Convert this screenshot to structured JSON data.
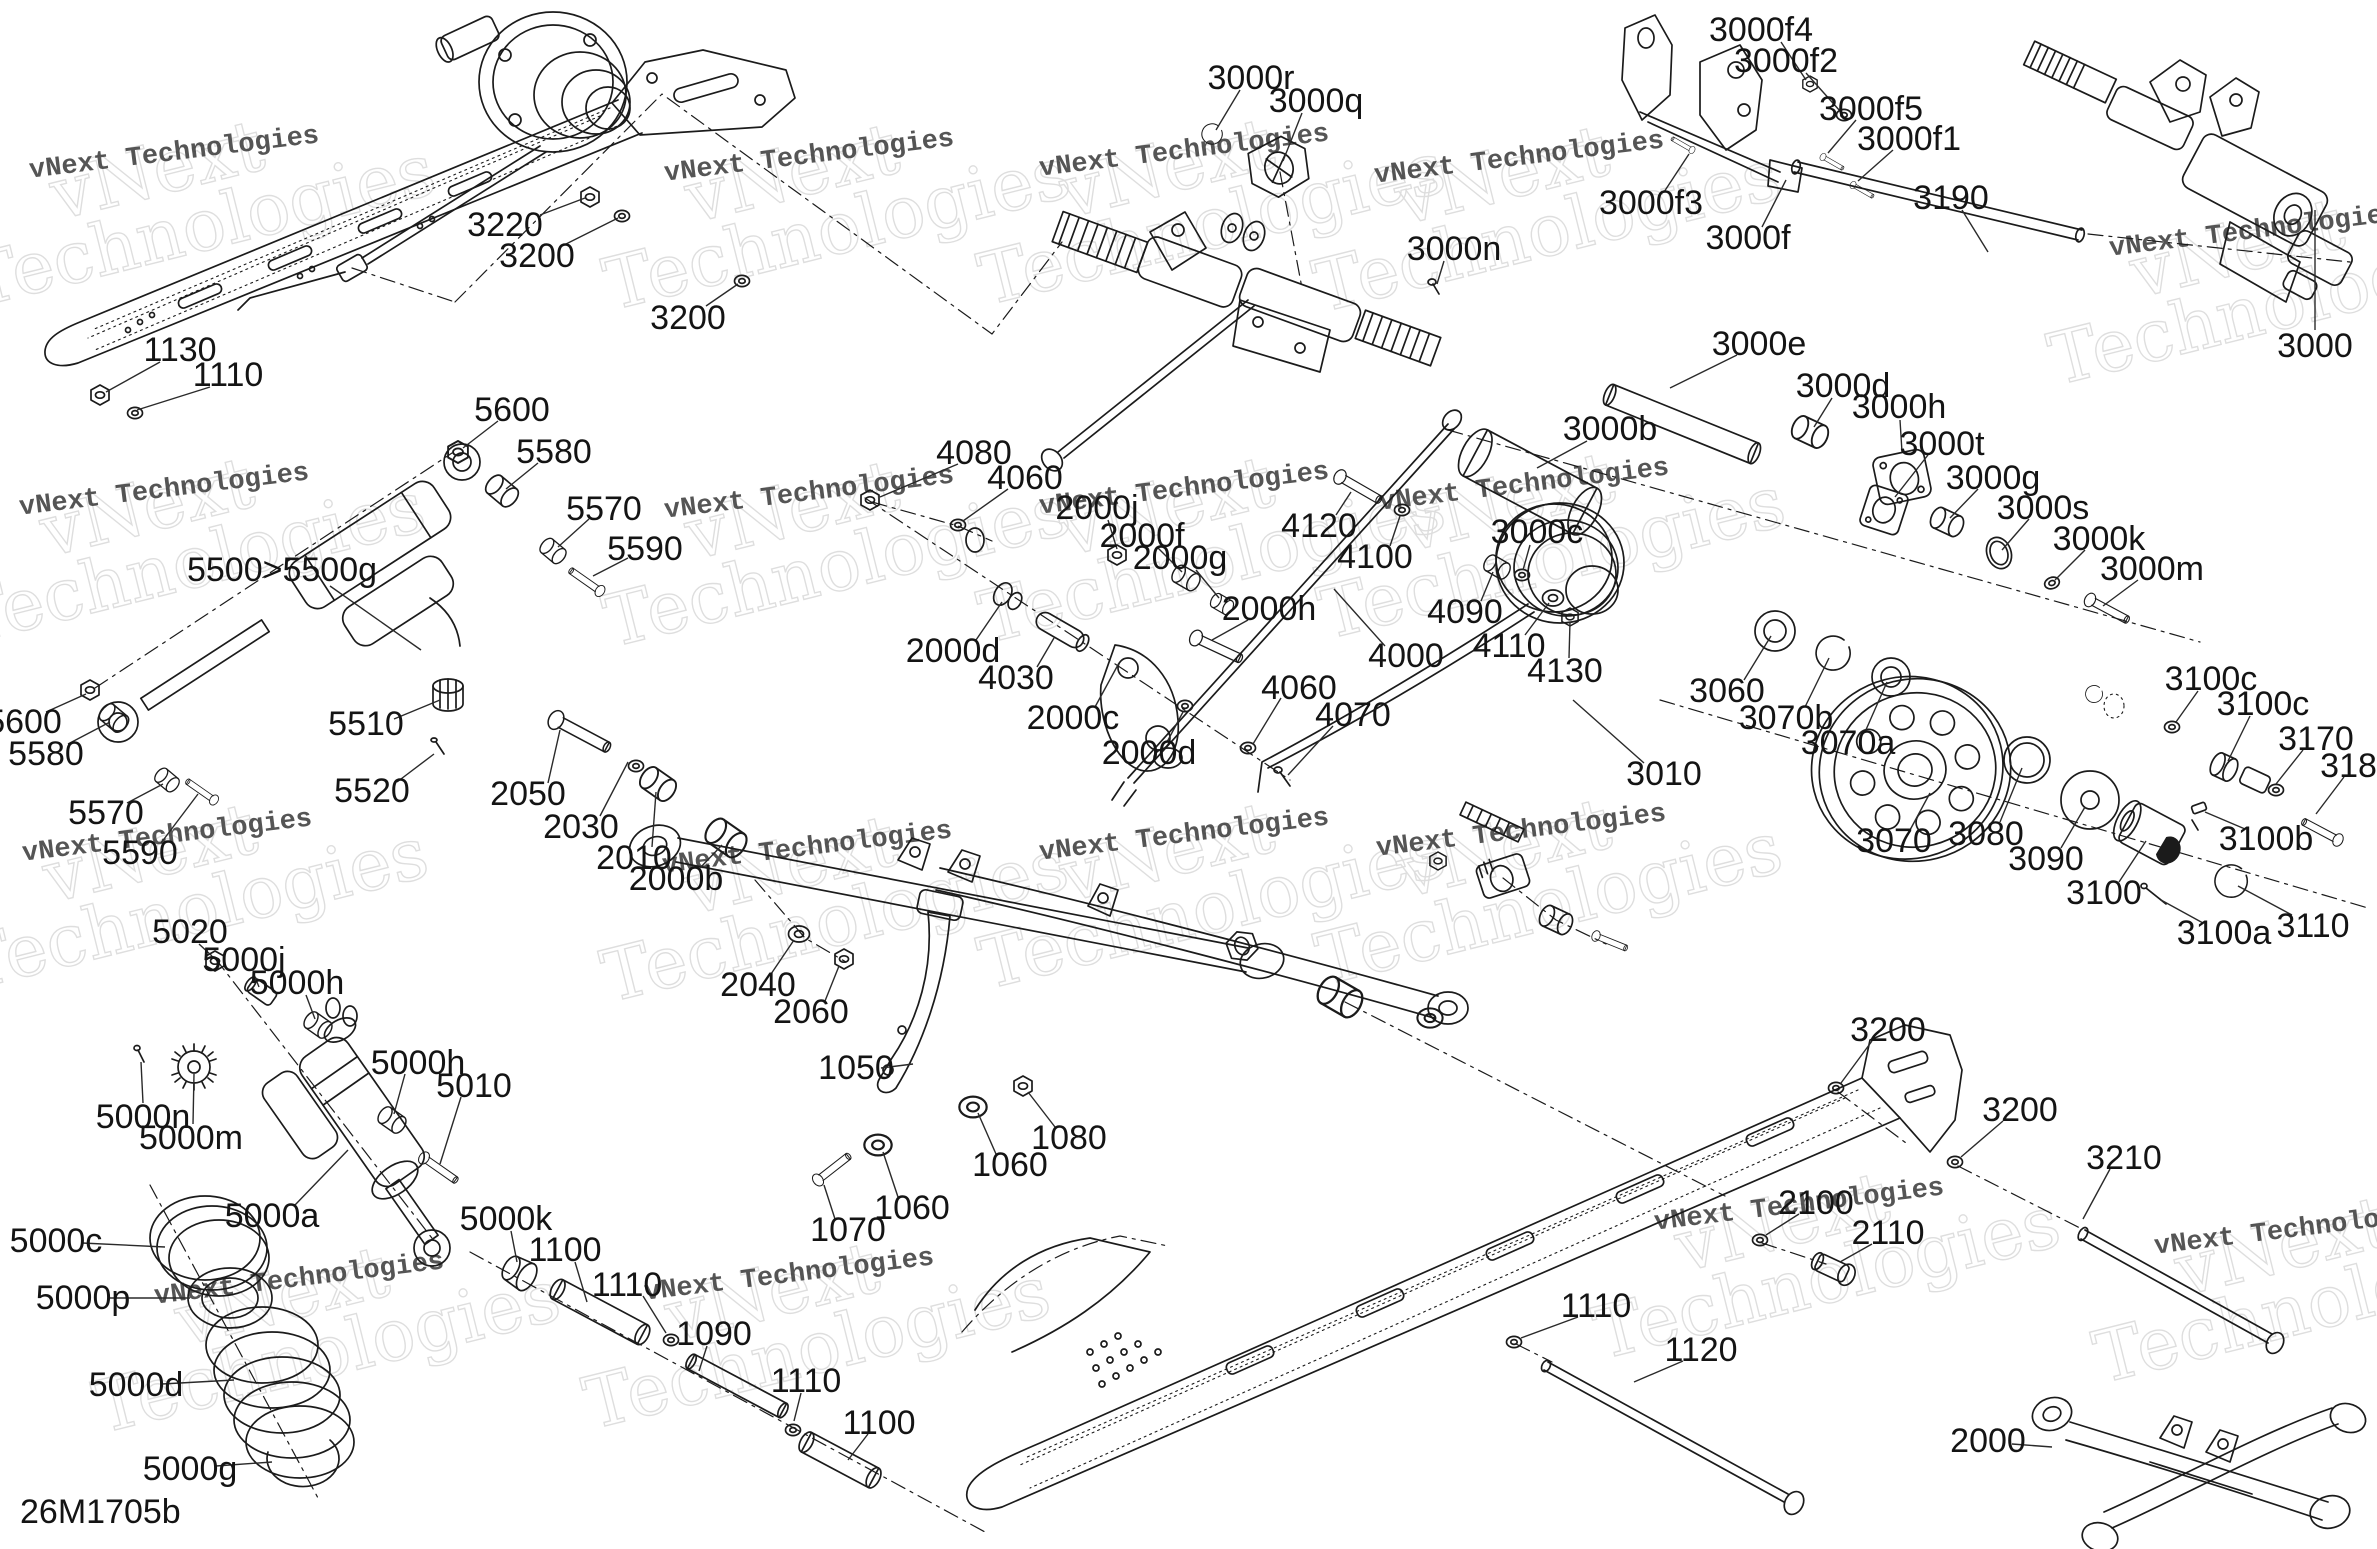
{
  "diagram": {
    "code": "26M1705b",
    "colors": {
      "line": "#1b1b1b",
      "label": "#141414",
      "watermark_small": "#3e3e3e",
      "watermark_big_outline": "#dddddd",
      "background": "#ffffff"
    },
    "watermark": {
      "small": "vNext Technologies",
      "big_line1": "vNext",
      "big_line2": "Technologies"
    },
    "watermarks": [
      {
        "x": 175,
        "y": 160
      },
      {
        "x": 810,
        "y": 163
      },
      {
        "x": 1185,
        "y": 158
      },
      {
        "x": 1520,
        "y": 165
      },
      {
        "x": 2255,
        "y": 238
      },
      {
        "x": 165,
        "y": 497
      },
      {
        "x": 810,
        "y": 500
      },
      {
        "x": 1185,
        "y": 496
      },
      {
        "x": 1525,
        "y": 492
      },
      {
        "x": 168,
        "y": 843
      },
      {
        "x": 808,
        "y": 855
      },
      {
        "x": 1185,
        "y": 842
      },
      {
        "x": 1522,
        "y": 838
      },
      {
        "x": 300,
        "y": 1286
      },
      {
        "x": 790,
        "y": 1282
      },
      {
        "x": 1800,
        "y": 1212
      },
      {
        "x": 2300,
        "y": 1236
      }
    ],
    "labels": [
      {
        "t": "3220",
        "x": 505,
        "y": 225,
        "l": [
          540,
          215,
          585,
          198
        ]
      },
      {
        "t": "3200",
        "x": 537,
        "y": 256,
        "l": [
          562,
          246,
          618,
          218
        ]
      },
      {
        "t": "3200",
        "x": 688,
        "y": 318,
        "l": [
          706,
          306,
          738,
          284
        ]
      },
      {
        "t": "1130",
        "x": 180,
        "y": 350,
        "l": [
          160,
          362,
          106,
          392
        ]
      },
      {
        "t": "1110",
        "x": 228,
        "y": 375,
        "l": [
          210,
          387,
          137,
          410
        ]
      },
      {
        "t": "5600",
        "x": 512,
        "y": 410,
        "l": [
          498,
          421,
          463,
          448
        ]
      },
      {
        "t": "5580",
        "x": 554,
        "y": 452,
        "l": [
          538,
          463,
          506,
          489
        ]
      },
      {
        "t": "5570",
        "x": 604,
        "y": 509,
        "l": [
          589,
          519,
          558,
          547
        ]
      },
      {
        "t": "5590",
        "x": 645,
        "y": 549,
        "l": [
          628,
          558,
          593,
          576
        ]
      },
      {
        "t": "5500>5500g",
        "x": 282,
        "y": 570,
        "l": [
          330,
          586,
          421,
          650
        ]
      },
      {
        "t": "5510",
        "x": 366,
        "y": 724,
        "l": [
          394,
          719,
          440,
          700
        ]
      },
      {
        "t": "5520",
        "x": 372,
        "y": 791,
        "l": [
          397,
          782,
          434,
          754
        ]
      },
      {
        "t": "5600",
        "x": 24,
        "y": 722,
        "l": [
          46,
          712,
          86,
          694
        ]
      },
      {
        "t": "5580",
        "x": 46,
        "y": 754,
        "l": [
          68,
          744,
          110,
          722
        ]
      },
      {
        "t": "5570",
        "x": 106,
        "y": 813,
        "l": [
          127,
          803,
          163,
          784
        ]
      },
      {
        "t": "5590",
        "x": 140,
        "y": 853,
        "l": [
          161,
          843,
          198,
          794
        ]
      },
      {
        "t": "2050",
        "x": 528,
        "y": 794,
        "l": [
          548,
          783,
          560,
          730
        ]
      },
      {
        "t": "2030",
        "x": 581,
        "y": 827,
        "l": [
          600,
          816,
          628,
          762
        ]
      },
      {
        "t": "2010",
        "x": 634,
        "y": 858,
        "l": [
          652,
          847,
          656,
          792
        ]
      },
      {
        "t": "2000b",
        "x": 676,
        "y": 879,
        "l": [
          700,
          868,
          722,
          845
        ]
      },
      {
        "t": "4080",
        "x": 974,
        "y": 453,
        "l": [
          958,
          464,
          880,
          497
        ]
      },
      {
        "t": "4060",
        "x": 1025,
        "y": 478,
        "l": [
          1008,
          489,
          963,
          521
        ]
      },
      {
        "t": "2000j",
        "x": 1097,
        "y": 508,
        "l": [
          1108,
          520,
          1117,
          549
        ]
      },
      {
        "t": "2000f",
        "x": 1142,
        "y": 536,
        "l": [
          1158,
          548,
          1182,
          572
        ]
      },
      {
        "t": "2000g",
        "x": 1180,
        "y": 558,
        "l": [
          1196,
          570,
          1219,
          598
        ]
      },
      {
        "t": "2000h",
        "x": 1269,
        "y": 609,
        "l": [
          1248,
          620,
          1212,
          640
        ]
      },
      {
        "t": "2000d",
        "x": 953,
        "y": 651,
        "l": [
          976,
          640,
          1002,
          602
        ]
      },
      {
        "t": "4030",
        "x": 1016,
        "y": 678,
        "l": [
          1037,
          667,
          1054,
          638
        ]
      },
      {
        "t": "2000c",
        "x": 1073,
        "y": 718,
        "l": [
          1095,
          707,
          1119,
          663
        ]
      },
      {
        "t": "2000d",
        "x": 1149,
        "y": 753,
        "l": [
          1167,
          742,
          1183,
          712
        ]
      },
      {
        "t": "4060",
        "x": 1299,
        "y": 688,
        "l": [
          1281,
          698,
          1253,
          744
        ]
      },
      {
        "t": "4070",
        "x": 1353,
        "y": 715,
        "l": [
          1333,
          726,
          1288,
          775
        ]
      },
      {
        "t": "3000r",
        "x": 1251,
        "y": 78,
        "l": [
          1240,
          90,
          1216,
          130
        ]
      },
      {
        "t": "3000q",
        "x": 1316,
        "y": 101,
        "l": [
          1302,
          113,
          1283,
          161
        ]
      },
      {
        "t": "3000n",
        "x": 1454,
        "y": 249,
        "l": [
          1444,
          261,
          1437,
          284
        ]
      },
      {
        "t": "4120",
        "x": 1319,
        "y": 526,
        "l": [
          1336,
          515,
          1351,
          492
        ]
      },
      {
        "t": "4100",
        "x": 1375,
        "y": 557,
        "l": [
          1390,
          546,
          1400,
          516
        ]
      },
      {
        "t": "3000c",
        "x": 1537,
        "y": 532,
        "l": [
          1530,
          545,
          1523,
          570
        ]
      },
      {
        "t": "4090",
        "x": 1465,
        "y": 612,
        "l": [
          1481,
          601,
          1493,
          572
        ]
      },
      {
        "t": "4110",
        "x": 1509,
        "y": 646,
        "l": [
          1525,
          635,
          1549,
          603
        ]
      },
      {
        "t": "4130",
        "x": 1565,
        "y": 671,
        "l": [
          1569,
          658,
          1570,
          622
        ]
      },
      {
        "t": "4000",
        "x": 1406,
        "y": 656,
        "l": [
          1385,
          646,
          1334,
          589
        ]
      },
      {
        "t": "3000b",
        "x": 1610,
        "y": 429,
        "l": [
          1587,
          441,
          1537,
          468
        ]
      },
      {
        "t": "3000e",
        "x": 1759,
        "y": 344,
        "l": [
          1737,
          355,
          1670,
          388
        ]
      },
      {
        "t": "3000d",
        "x": 1843,
        "y": 386,
        "l": [
          1832,
          398,
          1814,
          427
        ]
      },
      {
        "t": "3000h",
        "x": 1899,
        "y": 407,
        "l": [
          1900,
          420,
          1902,
          452
        ]
      },
      {
        "t": "3000t",
        "x": 1942,
        "y": 444,
        "l": [
          1928,
          455,
          1895,
          497
        ]
      },
      {
        "t": "3000g",
        "x": 1993,
        "y": 478,
        "l": [
          1978,
          489,
          1950,
          518
        ]
      },
      {
        "t": "3000s",
        "x": 2043,
        "y": 508,
        "l": [
          2029,
          519,
          2002,
          550
        ]
      },
      {
        "t": "3000k",
        "x": 2099,
        "y": 539,
        "l": [
          2085,
          550,
          2055,
          580
        ]
      },
      {
        "t": "3000m",
        "x": 2152,
        "y": 569,
        "l": [
          2138,
          580,
          2103,
          606
        ]
      },
      {
        "t": "3000",
        "x": 2315,
        "y": 346,
        "l": [
          2315,
          330,
          2315,
          210
        ]
      },
      {
        "t": "3000f4",
        "x": 1761,
        "y": 30,
        "l": [
          1781,
          42,
          1806,
          80
        ]
      },
      {
        "t": "3000f2",
        "x": 1786,
        "y": 61,
        "l": [
          1806,
          73,
          1840,
          111
        ]
      },
      {
        "t": "3000f5",
        "x": 1871,
        "y": 109,
        "l": [
          1856,
          120,
          1828,
          153
        ]
      },
      {
        "t": "3000f1",
        "x": 1909,
        "y": 139,
        "l": [
          1893,
          150,
          1858,
          181
        ]
      },
      {
        "t": "3190",
        "x": 1951,
        "y": 198,
        "l": [
          1962,
          210,
          1988,
          252
        ]
      },
      {
        "t": "3000f3",
        "x": 1651,
        "y": 203,
        "l": [
          1664,
          192,
          1689,
          154
        ]
      },
      {
        "t": "3000f",
        "x": 1748,
        "y": 238,
        "l": [
          1762,
          227,
          1786,
          180
        ]
      },
      {
        "t": "3060",
        "x": 1727,
        "y": 691,
        "l": [
          1744,
          680,
          1771,
          636
        ]
      },
      {
        "t": "3070b",
        "x": 1786,
        "y": 718,
        "l": [
          1805,
          707,
          1829,
          658
        ]
      },
      {
        "t": "3070a",
        "x": 1848,
        "y": 743,
        "l": [
          1865,
          732,
          1887,
          682
        ]
      },
      {
        "t": "3010",
        "x": 1664,
        "y": 774,
        "l": [
          1644,
          763,
          1573,
          700
        ]
      },
      {
        "t": "3070",
        "x": 1894,
        "y": 841,
        "l": [
          1910,
          830,
          1930,
          793
        ]
      },
      {
        "t": "3080",
        "x": 1986,
        "y": 834,
        "l": [
          2000,
          822,
          2022,
          768
        ]
      },
      {
        "t": "3090",
        "x": 2046,
        "y": 859,
        "l": [
          2061,
          848,
          2085,
          807
        ]
      },
      {
        "t": "3100",
        "x": 2104,
        "y": 893,
        "l": [
          2119,
          882,
          2146,
          841
        ]
      },
      {
        "t": "3100c",
        "x": 2211,
        "y": 679,
        "l": [
          2198,
          691,
          2176,
          722
        ]
      },
      {
        "t": "3100c",
        "x": 2263,
        "y": 704,
        "l": [
          2250,
          716,
          2228,
          761
        ]
      },
      {
        "t": "3170",
        "x": 2316,
        "y": 739,
        "l": [
          2303,
          750,
          2276,
          784
        ]
      },
      {
        "t": "3180",
        "x": 2358,
        "y": 766,
        "l": [
          2344,
          777,
          2316,
          814
        ]
      },
      {
        "t": "3100b",
        "x": 2266,
        "y": 839,
        "l": [
          2245,
          829,
          2205,
          812
        ]
      },
      {
        "t": "3100a",
        "x": 2224,
        "y": 933,
        "l": [
          2203,
          923,
          2161,
          900
        ]
      },
      {
        "t": "3110",
        "x": 2313,
        "y": 926,
        "l": [
          2292,
          915,
          2238,
          886
        ]
      },
      {
        "t": "5020",
        "x": 190,
        "y": 932,
        "l": [
          199,
          944,
          212,
          956
        ]
      },
      {
        "t": "5000j",
        "x": 244,
        "y": 960,
        "l": [
          253,
          972,
          259,
          987
        ]
      },
      {
        "t": "5000h",
        "x": 297,
        "y": 983,
        "l": [
          306,
          995,
          315,
          1019
        ]
      },
      {
        "t": "5000h",
        "x": 418,
        "y": 1063,
        "l": [
          405,
          1074,
          394,
          1114
        ]
      },
      {
        "t": "5010",
        "x": 474,
        "y": 1086,
        "l": [
          461,
          1097,
          440,
          1164
        ]
      },
      {
        "t": "5000n",
        "x": 143,
        "y": 1117,
        "l": [
          143,
          1103,
          141,
          1062
        ]
      },
      {
        "t": "5000m",
        "x": 191,
        "y": 1138,
        "l": [
          193,
          1124,
          194,
          1074
        ]
      },
      {
        "t": "5000a",
        "x": 272,
        "y": 1216,
        "l": [
          295,
          1205,
          348,
          1150
        ]
      },
      {
        "t": "5000k",
        "x": 506,
        "y": 1219,
        "l": [
          511,
          1231,
          517,
          1262
        ]
      },
      {
        "t": "1100",
        "x": 565,
        "y": 1250,
        "l": [
          575,
          1262,
          587,
          1302
        ]
      },
      {
        "t": "5000c",
        "x": 56,
        "y": 1241,
        "l": [
          82,
          1243,
          165,
          1247
        ]
      },
      {
        "t": "5000p",
        "x": 83,
        "y": 1298,
        "l": [
          110,
          1298,
          190,
          1298
        ]
      },
      {
        "t": "5000d",
        "x": 136,
        "y": 1385,
        "l": [
          162,
          1384,
          234,
          1380
        ]
      },
      {
        "t": "5000g",
        "x": 190,
        "y": 1469,
        "l": [
          216,
          1466,
          272,
          1462
        ]
      },
      {
        "t": "2040",
        "x": 758,
        "y": 985,
        "l": [
          771,
          974,
          794,
          940
        ]
      },
      {
        "t": "2060",
        "x": 811,
        "y": 1012,
        "l": [
          825,
          1001,
          839,
          966
        ]
      },
      {
        "t": "1050",
        "x": 856,
        "y": 1068,
        "l": [
          881,
          1068,
          913,
          1064
        ]
      },
      {
        "t": "1080",
        "x": 1069,
        "y": 1138,
        "l": [
          1055,
          1127,
          1028,
          1092
        ]
      },
      {
        "t": "1060",
        "x": 1010,
        "y": 1165,
        "l": [
          996,
          1154,
          978,
          1113
        ]
      },
      {
        "t": "1060",
        "x": 912,
        "y": 1208,
        "l": [
          898,
          1197,
          883,
          1152
        ]
      },
      {
        "t": "1070",
        "x": 848,
        "y": 1230,
        "l": [
          835,
          1219,
          824,
          1185
        ]
      },
      {
        "t": "1110",
        "x": 627,
        "y": 1285,
        "l": [
          643,
          1296,
          666,
          1333
        ]
      },
      {
        "t": "1090",
        "x": 714,
        "y": 1334,
        "l": [
          707,
          1346,
          699,
          1371
        ]
      },
      {
        "t": "1110",
        "x": 806,
        "y": 1381,
        "l": [
          801,
          1393,
          794,
          1421
        ]
      },
      {
        "t": "1100",
        "x": 879,
        "y": 1423,
        "l": [
          868,
          1434,
          848,
          1460
        ]
      },
      {
        "t": "3200",
        "x": 1888,
        "y": 1030,
        "l": [
          1872,
          1041,
          1841,
          1083
        ]
      },
      {
        "t": "3200",
        "x": 2020,
        "y": 1110,
        "l": [
          2003,
          1121,
          1961,
          1157
        ]
      },
      {
        "t": "3210",
        "x": 2124,
        "y": 1158,
        "l": [
          2110,
          1169,
          2083,
          1219
        ]
      },
      {
        "t": "2100",
        "x": 1816,
        "y": 1203,
        "l": [
          1799,
          1214,
          1766,
          1235
        ]
      },
      {
        "t": "2110",
        "x": 1888,
        "y": 1233,
        "l": [
          1872,
          1244,
          1840,
          1262
        ]
      },
      {
        "t": "1110",
        "x": 1596,
        "y": 1306,
        "l": [
          1578,
          1317,
          1521,
          1338
        ]
      },
      {
        "t": "1120",
        "x": 1701,
        "y": 1350,
        "l": [
          1683,
          1361,
          1634,
          1382
        ]
      },
      {
        "t": "2000",
        "x": 1988,
        "y": 1441,
        "l": [
          2012,
          1444,
          2052,
          1447
        ]
      }
    ]
  }
}
